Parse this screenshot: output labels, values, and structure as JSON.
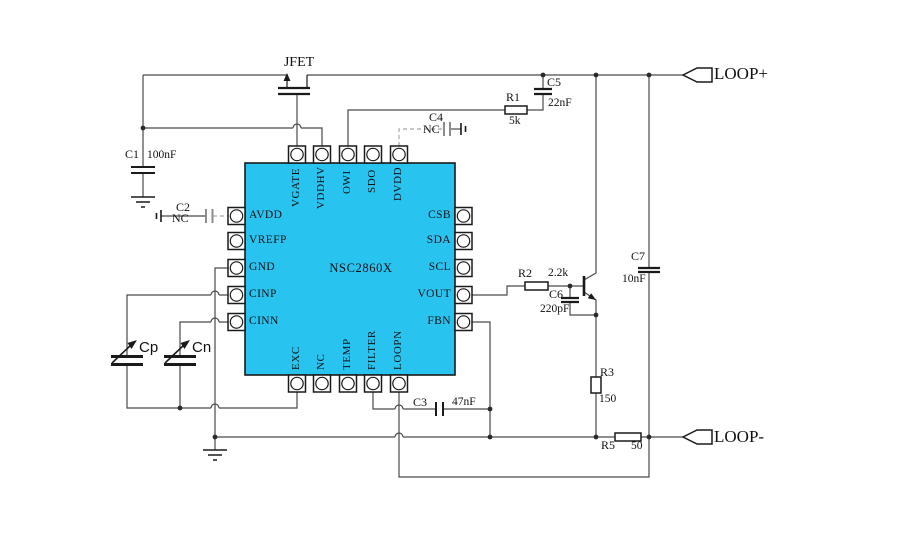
{
  "chip": {
    "name": "NSC2860X",
    "pins": {
      "top": [
        "VGATE",
        "VDDHV",
        "OWI",
        "SDO",
        "DVDD"
      ],
      "bottom": [
        "EXC",
        "NC",
        "TEMP",
        "FILTER",
        "LOOPN"
      ],
      "left": [
        "AVDD",
        "VREFP",
        "GND",
        "CINP",
        "CINN"
      ],
      "right": [
        "CSB",
        "SDA",
        "SCL",
        "VOUT",
        "FBN"
      ]
    }
  },
  "components": {
    "jfet": {
      "ref": "JFET"
    },
    "c1": {
      "ref": "C1",
      "value": "100nF"
    },
    "c2": {
      "ref": "C2",
      "value": "NC"
    },
    "c3": {
      "ref": "C3",
      "value": "47nF"
    },
    "c4": {
      "ref": "C4",
      "value": "NC"
    },
    "c5": {
      "ref": "C5",
      "value": "22nF"
    },
    "c6": {
      "ref": "C6",
      "value": "220pF"
    },
    "c7": {
      "ref": "C7",
      "value": "10nF"
    },
    "r1": {
      "ref": "R1",
      "value": "5k"
    },
    "r2": {
      "ref": "R2",
      "value": "2.2k"
    },
    "r3": {
      "ref": "R3",
      "value": "150"
    },
    "r5": {
      "ref": "R5",
      "value": "50"
    },
    "cp": {
      "ref": "Cp"
    },
    "cn": {
      "ref": "Cn"
    }
  },
  "connectors": {
    "loop_plus": "LOOP+",
    "loop_minus": "LOOP-"
  },
  "colors": {
    "chip_fill": "#29c3f0",
    "wire": "#4a4a4a",
    "nc_grey": "#9a9a9a"
  }
}
